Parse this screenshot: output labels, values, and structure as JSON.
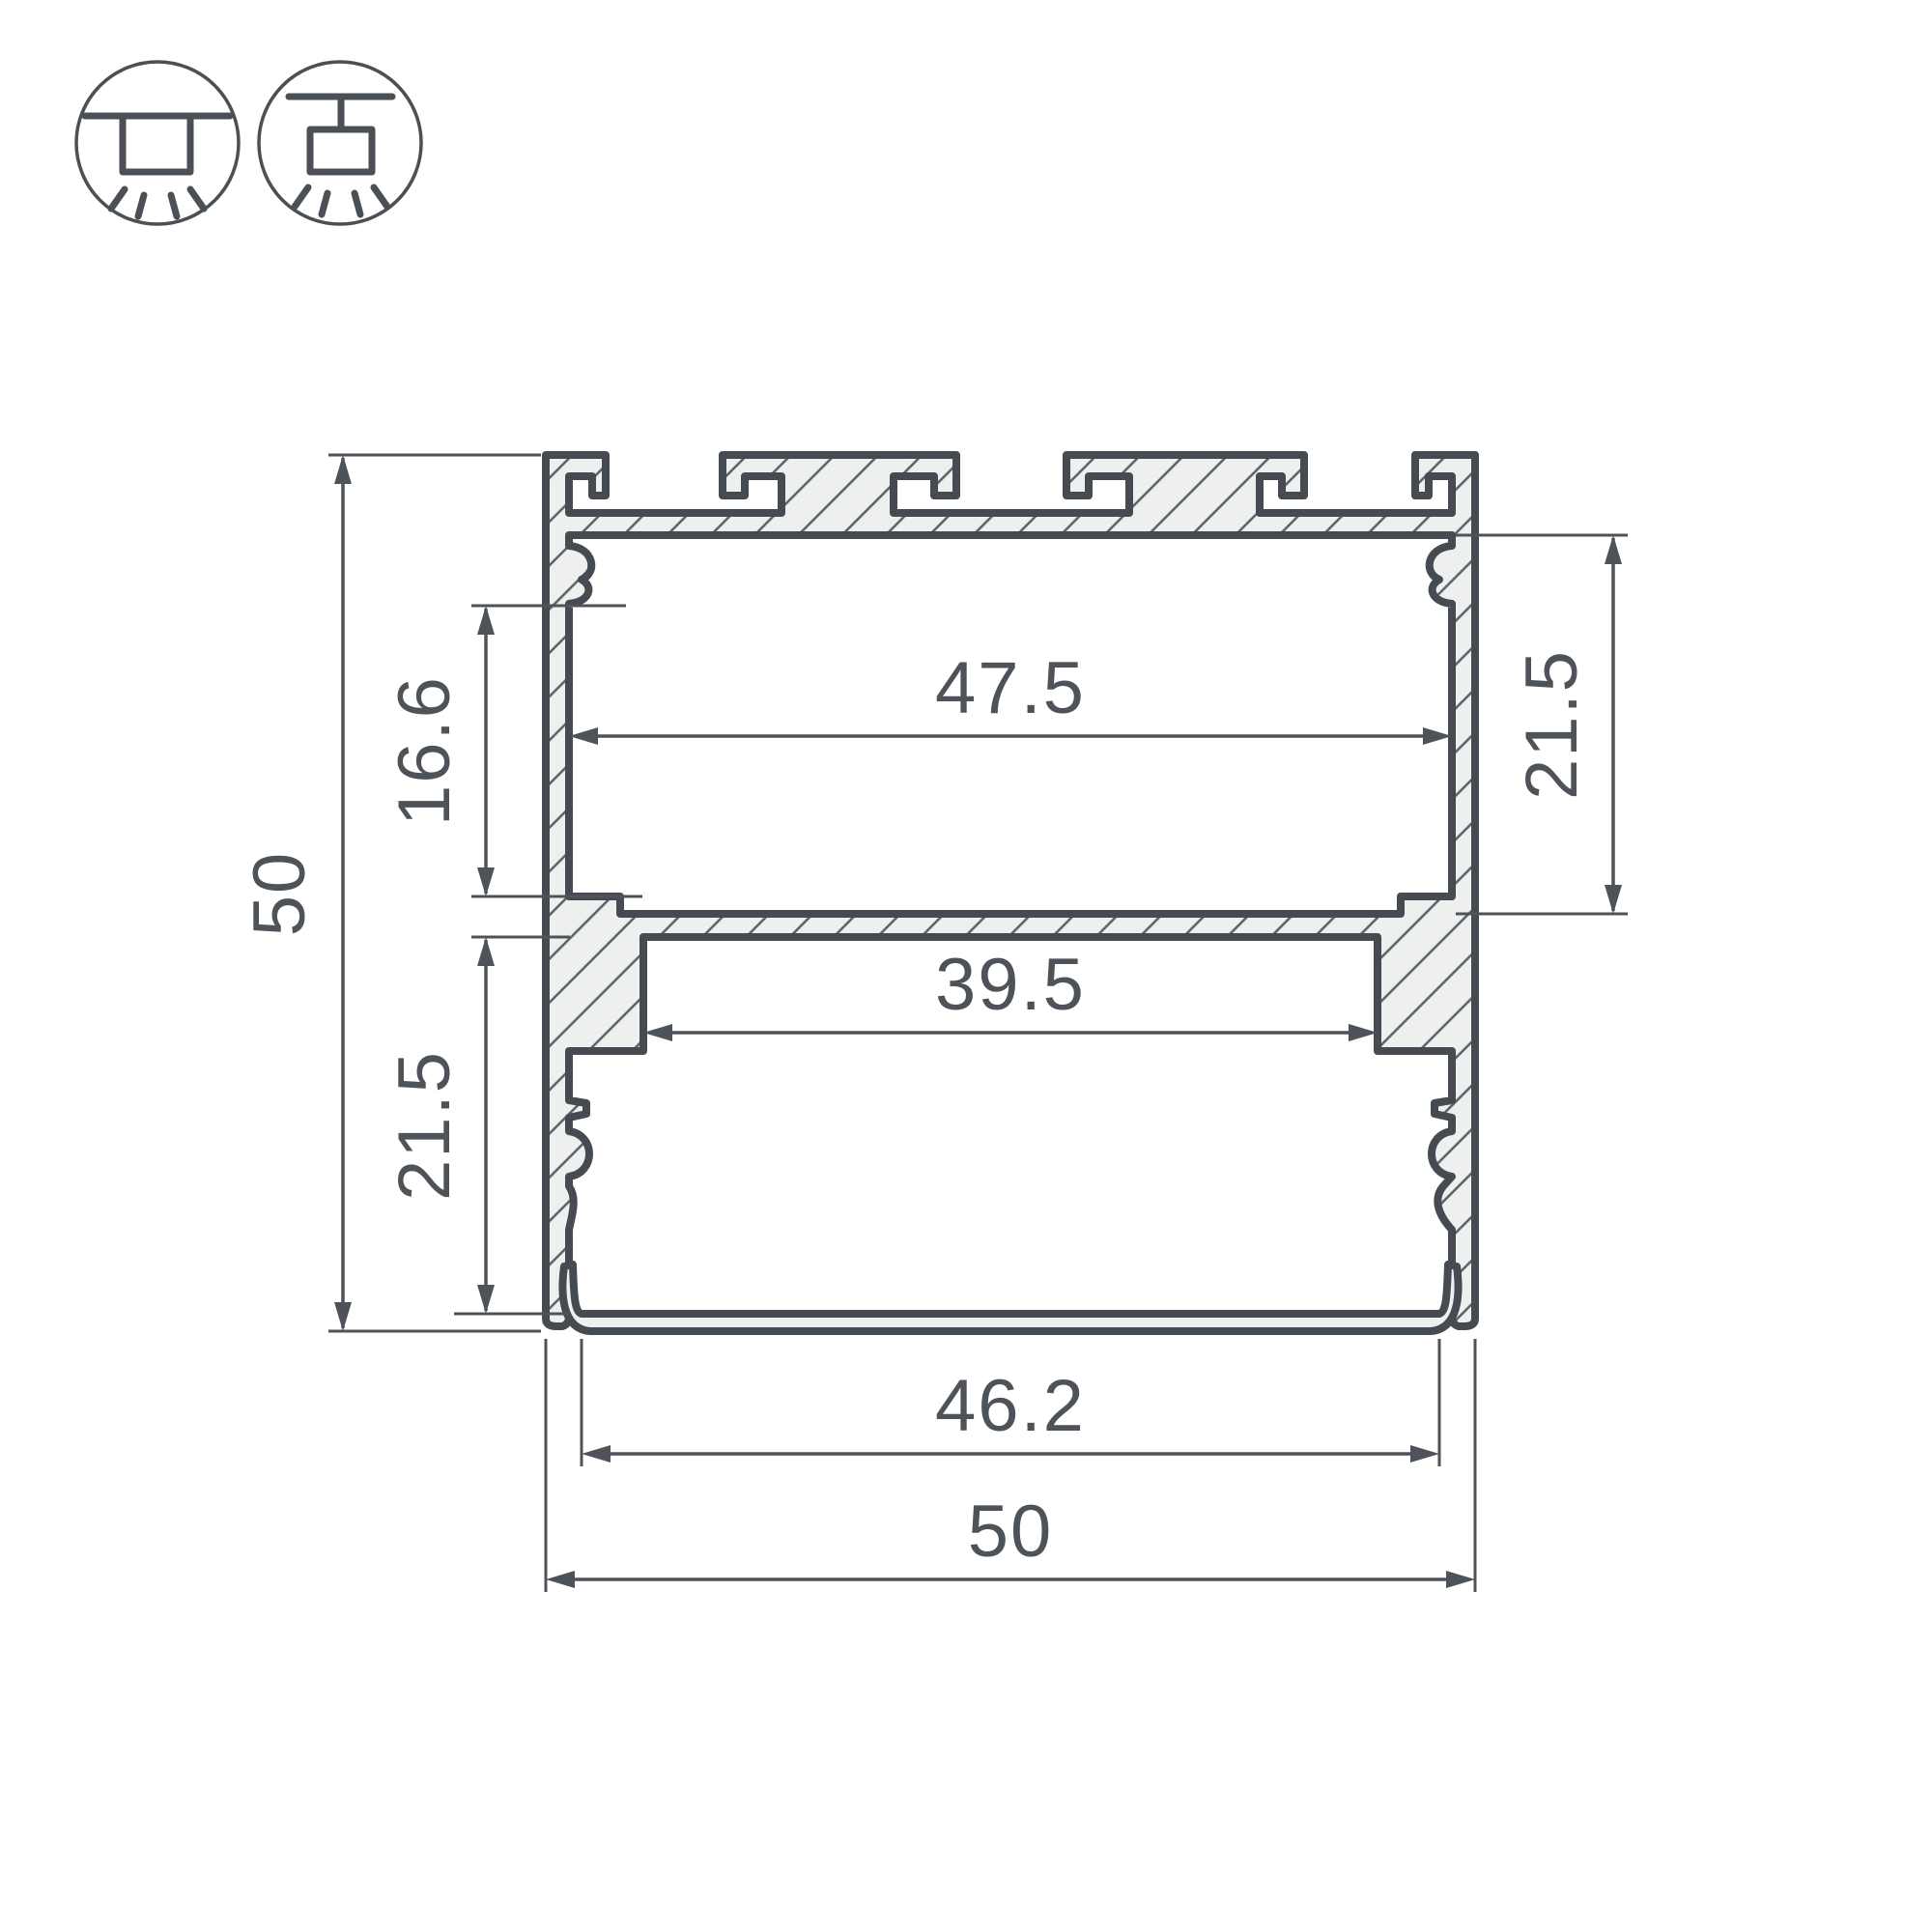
{
  "drawing": {
    "dims": {
      "overall_height": "50",
      "overall_width": "50",
      "top_inner_width": "47.5",
      "mid_channel_width": "39.5",
      "bottom_inner_width": "46.2",
      "left_upper": "16.6",
      "left_lower": "21.5",
      "right_side": "21.5"
    },
    "icons": {
      "surface": "surface-mount",
      "pendant": "pendant-mount"
    },
    "colors": {
      "line": "#4d5358",
      "metal_fill": "#eef0ef",
      "hatch": "#5a6065",
      "background": "#ffffff"
    }
  }
}
